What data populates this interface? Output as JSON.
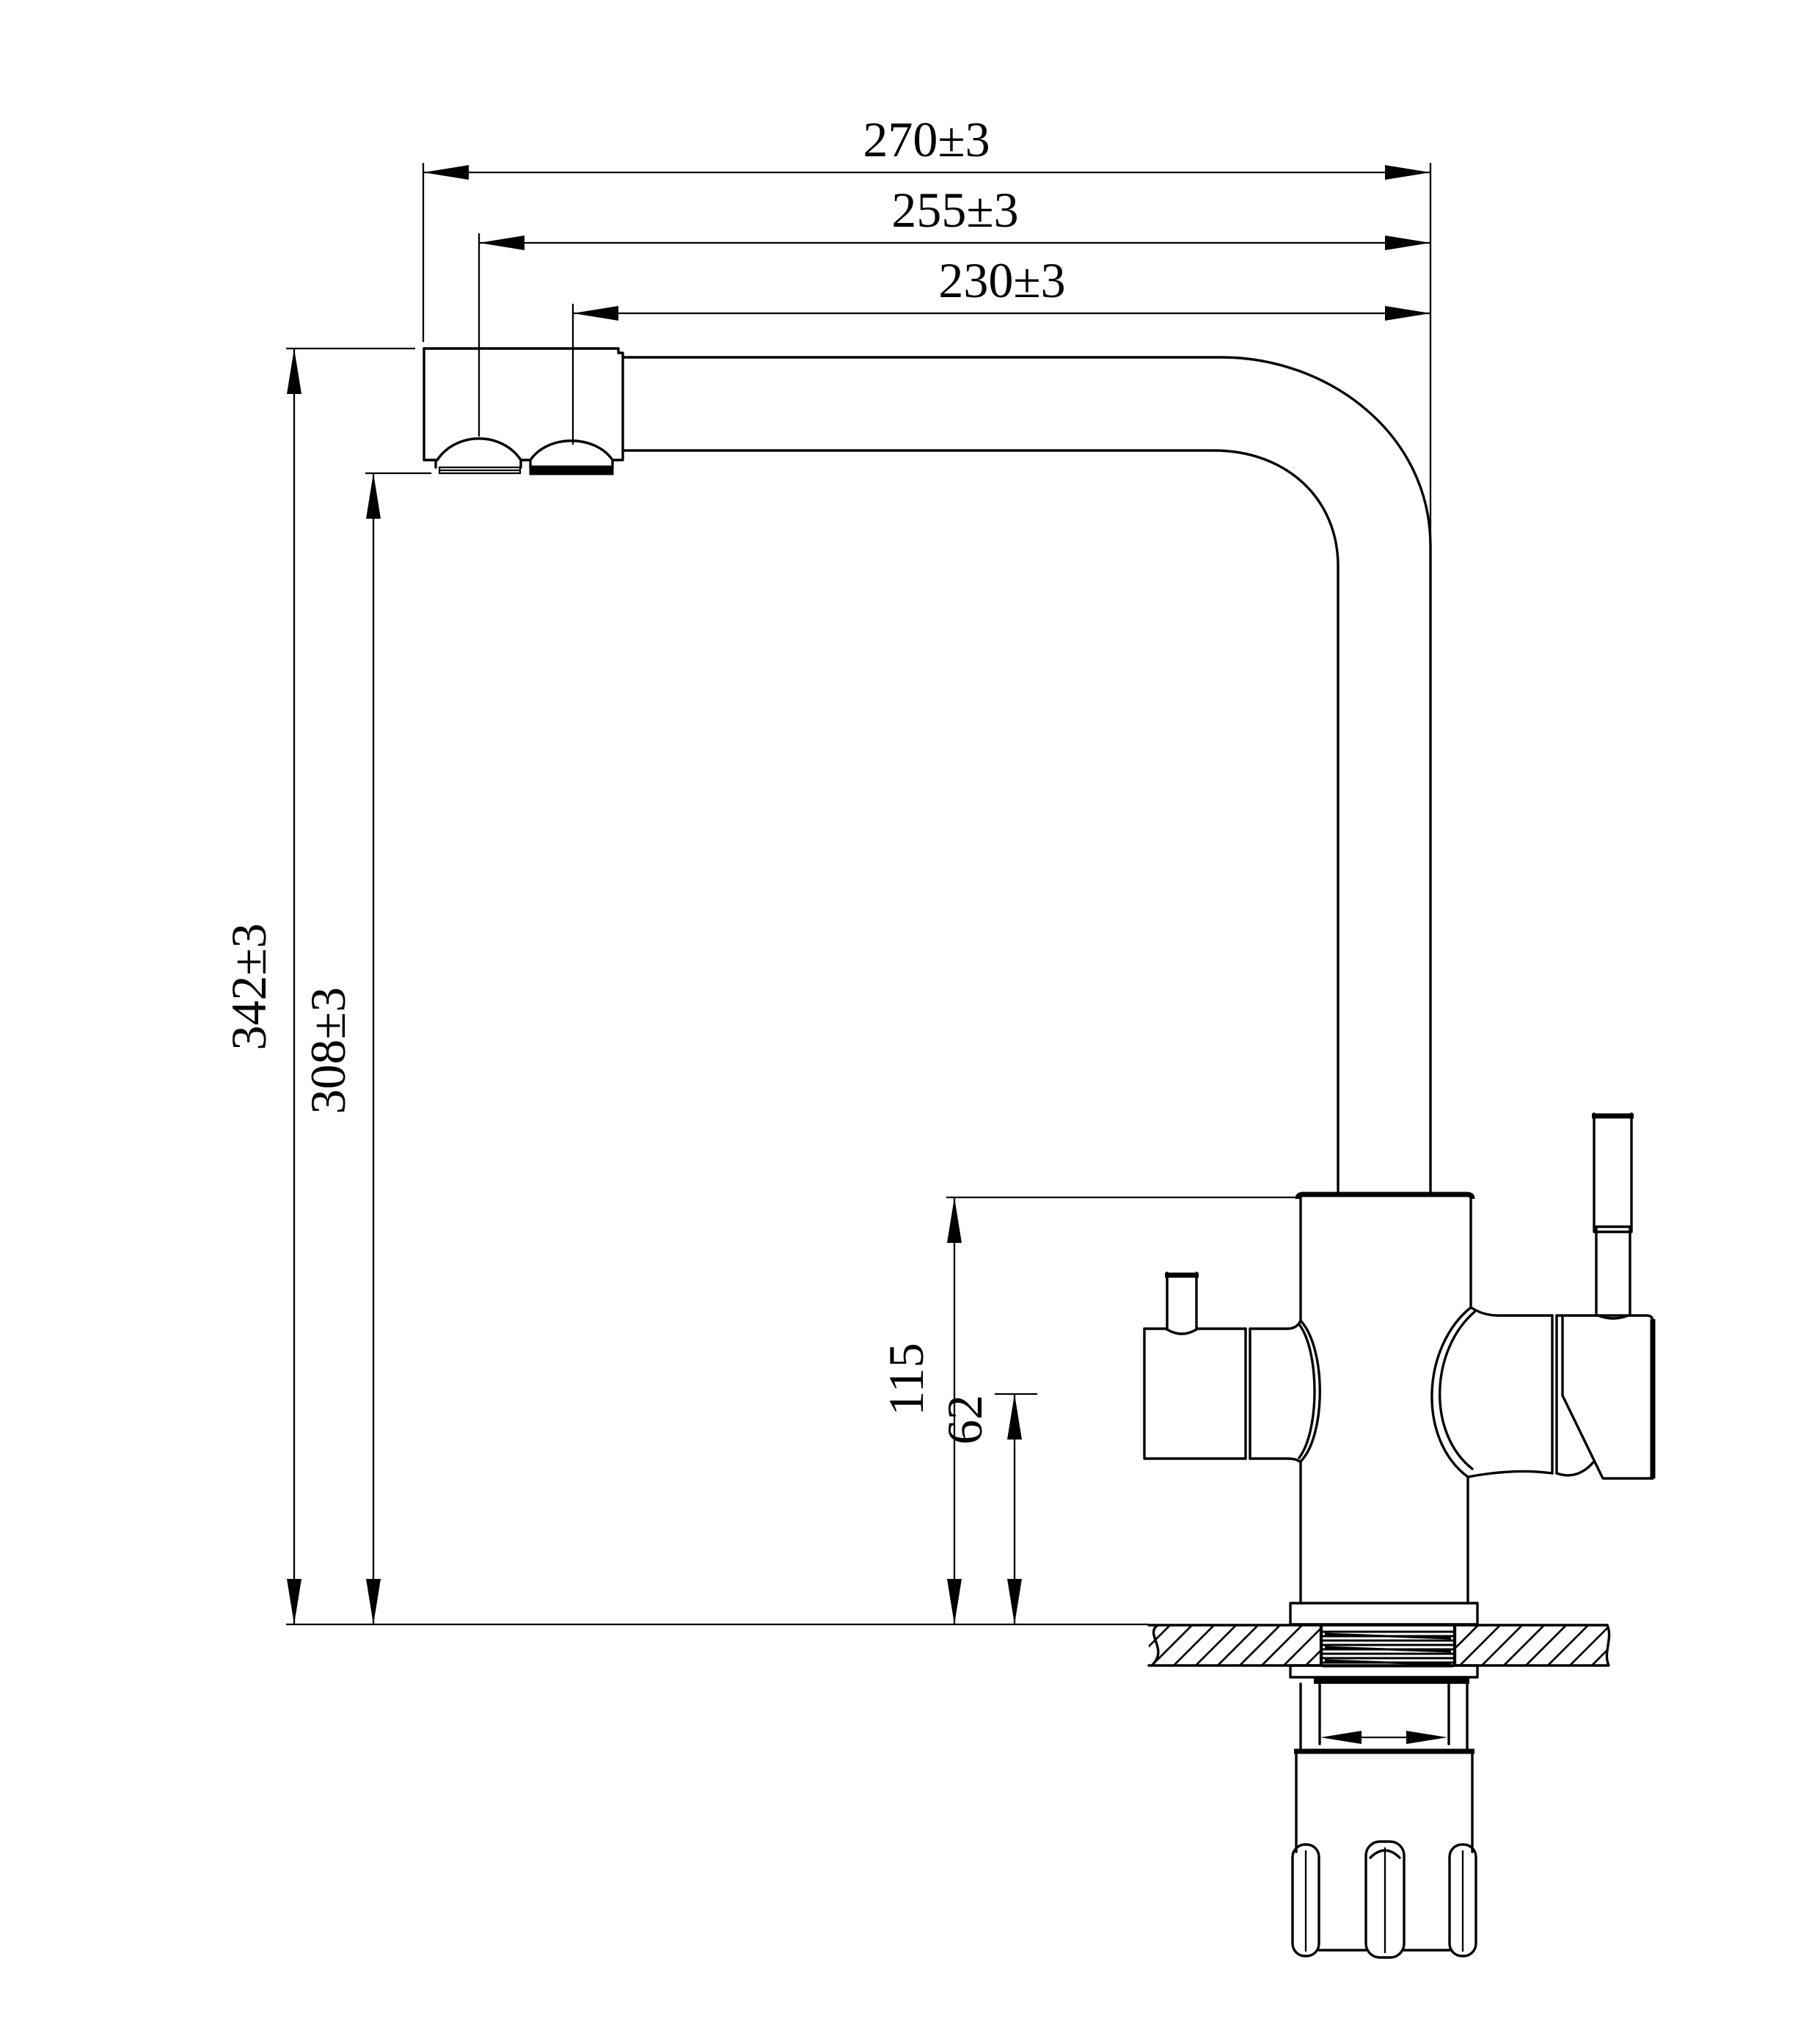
{
  "page": {
    "background": "#ffffff",
    "line_color": "#000000",
    "drawing_type": "faucet-dimension-drawing"
  },
  "dimensions": {
    "width_overall": {
      "label": "270±3"
    },
    "width_mid": {
      "label": "255±3"
    },
    "width_inner": {
      "label": "230±3"
    },
    "height_overall": {
      "label": "342±3"
    },
    "height_spout": {
      "label": "308±3"
    },
    "height_body": {
      "label": "115"
    },
    "height_outlet": {
      "label": "62"
    }
  }
}
